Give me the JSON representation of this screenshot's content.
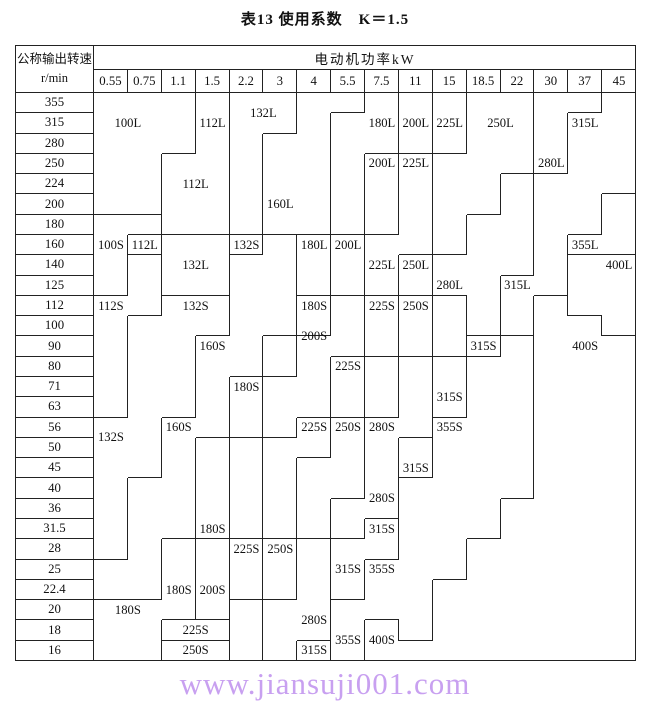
{
  "title": "表13 使用系数　K＝1.5",
  "header": {
    "speed_label": "公称输出转速",
    "speed_unit": "r/min",
    "power_label": "电动机功率kW",
    "powers": [
      "0.55",
      "0.75",
      "1.1",
      "1.5",
      "2.2",
      "3",
      "4",
      "5.5",
      "7.5",
      "11",
      "15",
      "18.5",
      "22",
      "30",
      "37",
      "45"
    ]
  },
  "speeds": [
    "355",
    "315",
    "280",
    "250",
    "224",
    "200",
    "180",
    "160",
    "140",
    "125",
    "112",
    "100",
    "90",
    "80",
    "71",
    "63",
    "56",
    "50",
    "45",
    "40",
    "36",
    "31.5",
    "28",
    "25",
    "22.4",
    "20",
    "18",
    "16"
  ],
  "chart_data": {
    "type": "table",
    "note": "stepped motor-frame selection regions; runs are [frame, firstRow, lastRow] per power column",
    "column_runs": {
      "c0": [
        [
          "100L",
          0,
          5
        ],
        [
          "100S",
          6,
          9
        ],
        [
          "112S",
          10,
          15
        ],
        [
          "132S",
          16,
          22
        ],
        [
          "160S",
          23,
          24
        ],
        [
          "180S",
          25,
          27
        ]
      ],
      "c1": [
        [
          "100L",
          0,
          5
        ],
        [
          "100S",
          6,
          6
        ],
        [
          "112L",
          7,
          7
        ],
        [
          "112S",
          8,
          10
        ],
        [
          "132S",
          11,
          18
        ],
        [
          "160S",
          19,
          24
        ],
        [
          "180S",
          25,
          27
        ]
      ],
      "c2": [
        [
          "100L",
          0,
          2
        ],
        [
          "112L",
          3,
          6
        ],
        [
          "132L",
          7,
          9
        ],
        [
          "132S",
          10,
          15
        ],
        [
          "160S",
          16,
          21
        ],
        [
          "180S",
          22,
          25
        ],
        [
          "225S",
          26,
          26
        ],
        [
          "250S",
          27,
          27
        ]
      ],
      "c3": [
        [
          "112L",
          0,
          6
        ],
        [
          "132L",
          7,
          9
        ],
        [
          "132S",
          10,
          11
        ],
        [
          "160S",
          12,
          16
        ],
        [
          "180S",
          17,
          21
        ],
        [
          "200S",
          22,
          25
        ],
        [
          "225S",
          26,
          26
        ],
        [
          "250S",
          27,
          27
        ]
      ],
      "c4": [
        [
          "132L",
          0,
          6
        ],
        [
          "132S.b",
          7,
          7
        ],
        [
          "160S",
          8,
          13
        ],
        [
          "180S",
          14,
          16
        ],
        [
          "200S",
          17,
          21
        ],
        [
          "225S",
          22,
          24
        ],
        [
          "250S.b",
          25,
          27
        ]
      ],
      "c5": [
        [
          "132L",
          0,
          1
        ],
        [
          "160L",
          2,
          6
        ],
        [
          "160S",
          7,
          11
        ],
        [
          "180S",
          12,
          13
        ],
        [
          "200S",
          14,
          16
        ],
        [
          "225S",
          17,
          21
        ],
        [
          "250S",
          22,
          24
        ],
        [
          "280S",
          25,
          27
        ]
      ],
      "c6": [
        [
          "160L",
          0,
          6
        ],
        [
          "180L",
          7,
          9
        ],
        [
          "180S",
          10,
          11
        ],
        [
          "200S",
          12,
          15
        ],
        [
          "225S",
          16,
          17
        ],
        [
          "250S",
          18,
          21
        ],
        [
          "280S",
          22,
          26
        ],
        [
          "315S.b",
          27,
          27
        ]
      ],
      "c7": [
        [
          "160L",
          0,
          0
        ],
        [
          "180L",
          1,
          6
        ],
        [
          "200L",
          7,
          9
        ],
        [
          "200S",
          10,
          12
        ],
        [
          "225S",
          13,
          15
        ],
        [
          "250S",
          16,
          19
        ],
        [
          "280S",
          20,
          21
        ],
        [
          "315S",
          22,
          24
        ],
        [
          "355S",
          25,
          27
        ]
      ],
      "c8": [
        [
          "180L",
          0,
          2
        ],
        [
          "200L",
          3,
          6
        ],
        [
          "225L",
          7,
          9
        ],
        [
          "225S",
          10,
          12
        ],
        [
          "250S",
          13,
          15
        ],
        [
          "280S",
          16,
          20
        ],
        [
          "315S",
          21,
          22
        ],
        [
          "355S",
          23,
          25
        ],
        [
          "400S",
          26,
          27
        ]
      ],
      "c9": [
        [
          "200L",
          0,
          2
        ],
        [
          "225L",
          3,
          7
        ],
        [
          "250L",
          8,
          9
        ],
        [
          "250S",
          10,
          12
        ],
        [
          "280S",
          13,
          16
        ],
        [
          "315S",
          17,
          18
        ],
        [
          "355S",
          19,
          26
        ],
        [
          "400S",
          27,
          27
        ]
      ],
      "c10": [
        [
          "225L",
          0,
          2
        ],
        [
          "250L",
          3,
          7
        ],
        [
          "280L",
          8,
          9
        ],
        [
          "280S",
          10,
          12
        ],
        [
          "315S",
          13,
          15
        ],
        [
          "355S",
          16,
          23
        ],
        [
          "400S",
          24,
          27
        ]
      ],
      "c11": [
        [
          "250L",
          0,
          5
        ],
        [
          "280L",
          6,
          11
        ],
        [
          "315S",
          12,
          12
        ],
        [
          "355S",
          13,
          21
        ],
        [
          "400S",
          22,
          27
        ]
      ],
      "c12": [
        [
          "250L",
          0,
          3
        ],
        [
          "280L",
          4,
          8
        ],
        [
          "315L",
          9,
          11
        ],
        [
          "355S",
          12,
          19
        ],
        [
          "400S",
          20,
          27
        ]
      ],
      "c13": [
        [
          "280L",
          0,
          3
        ],
        [
          "315L",
          4,
          9
        ],
        [
          "400S",
          10,
          27
        ]
      ],
      "c14": [
        [
          "280L",
          0,
          0
        ],
        [
          "315L",
          1,
          6
        ],
        [
          "355L",
          7,
          7
        ],
        [
          "400L",
          8,
          10
        ],
        [
          "400S",
          11,
          27
        ]
      ],
      "c15": [
        [
          "315L",
          0,
          4
        ],
        [
          "355L",
          5,
          7
        ],
        [
          "400L",
          8,
          11
        ],
        [
          "400S",
          12,
          27
        ]
      ]
    },
    "labels": [
      [
        "100L",
        0,
        1,
        0,
        2
      ],
      [
        "112L",
        3,
        3,
        0,
        2
      ],
      [
        "132L",
        4,
        5,
        0,
        1
      ],
      [
        "180L",
        8,
        8,
        0,
        2
      ],
      [
        "200L",
        9,
        9,
        0,
        2
      ],
      [
        "225L",
        10,
        10,
        0,
        2
      ],
      [
        "250L",
        11,
        12,
        0,
        2
      ],
      [
        "315L",
        14,
        14,
        0,
        2
      ],
      [
        "280L",
        13,
        13,
        2,
        4
      ],
      [
        "200L",
        8,
        8,
        3,
        3
      ],
      [
        "225L",
        9,
        9,
        3,
        3
      ],
      [
        "112L",
        2,
        3,
        3,
        5
      ],
      [
        "160L",
        5,
        5,
        4,
        6
      ],
      [
        "100S",
        0,
        0,
        7,
        7
      ],
      [
        "112L",
        1,
        1,
        7,
        7
      ],
      [
        "132L",
        2,
        3,
        7,
        9
      ],
      [
        "132S",
        4,
        4,
        7,
        7
      ],
      [
        "180L",
        6,
        6,
        7,
        7
      ],
      [
        "200L",
        7,
        7,
        7,
        7
      ],
      [
        "355L",
        14,
        14,
        7,
        7
      ],
      [
        "225L",
        8,
        8,
        8,
        8
      ],
      [
        "250L",
        9,
        9,
        8,
        8
      ],
      [
        "400L",
        15,
        15,
        8,
        8
      ],
      [
        "280L",
        10,
        10,
        9,
        9
      ],
      [
        "315L",
        12,
        12,
        9,
        9
      ],
      [
        "112S",
        0,
        0,
        10,
        10
      ],
      [
        "132S",
        2,
        3,
        10,
        10
      ],
      [
        "180S",
        6,
        6,
        10,
        10
      ],
      [
        "225S",
        8,
        8,
        10,
        10
      ],
      [
        "250S",
        9,
        9,
        10,
        10
      ],
      [
        "200S",
        6,
        6,
        11,
        12
      ],
      [
        "160S",
        3,
        3,
        12,
        12
      ],
      [
        "315S",
        11,
        11,
        12,
        12
      ],
      [
        "400S",
        14,
        14,
        12,
        12
      ],
      [
        "225S",
        7,
        7,
        13,
        13
      ],
      [
        "180S",
        4,
        4,
        14,
        14
      ],
      [
        "315S",
        10,
        10,
        14,
        15
      ],
      [
        "132S",
        0,
        0,
        16,
        17
      ],
      [
        "160S",
        2,
        2,
        16,
        16
      ],
      [
        "225S",
        6,
        6,
        16,
        16
      ],
      [
        "250S",
        7,
        7,
        16,
        16
      ],
      [
        "280S",
        8,
        8,
        16,
        16
      ],
      [
        "355S",
        10,
        10,
        16,
        16
      ],
      [
        "315S",
        9,
        9,
        18,
        18
      ],
      [
        "280S",
        8,
        8,
        19,
        20
      ],
      [
        "180S",
        3,
        3,
        21,
        21
      ],
      [
        "315S",
        8,
        8,
        21,
        21
      ],
      [
        "225S",
        4,
        4,
        22,
        22
      ],
      [
        "250S",
        5,
        5,
        22,
        22
      ],
      [
        "315S",
        7,
        7,
        23,
        23
      ],
      [
        "355S",
        8,
        8,
        23,
        23
      ],
      [
        "180S",
        2,
        2,
        24,
        24
      ],
      [
        "200S",
        3,
        3,
        24,
        24
      ],
      [
        "180S",
        0,
        1,
        25,
        25
      ],
      [
        "280S",
        6,
        6,
        25,
        26
      ],
      [
        "225S",
        2,
        3,
        26,
        26
      ],
      [
        "355S",
        7,
        7,
        26,
        27
      ],
      [
        "400S",
        8,
        8,
        26,
        27
      ],
      [
        "250S",
        2,
        3,
        27,
        27
      ],
      [
        "315S",
        6,
        6,
        27,
        27
      ]
    ],
    "layout": {
      "rows": 28,
      "cols": 16,
      "speed_col_width": 78,
      "col_width": 33.875,
      "row_height": 20.286,
      "header_h1": 24,
      "header_h2": 23
    }
  },
  "footer": {
    "url": "www.jiansuji001.com",
    "color": "#c8a0f0"
  }
}
